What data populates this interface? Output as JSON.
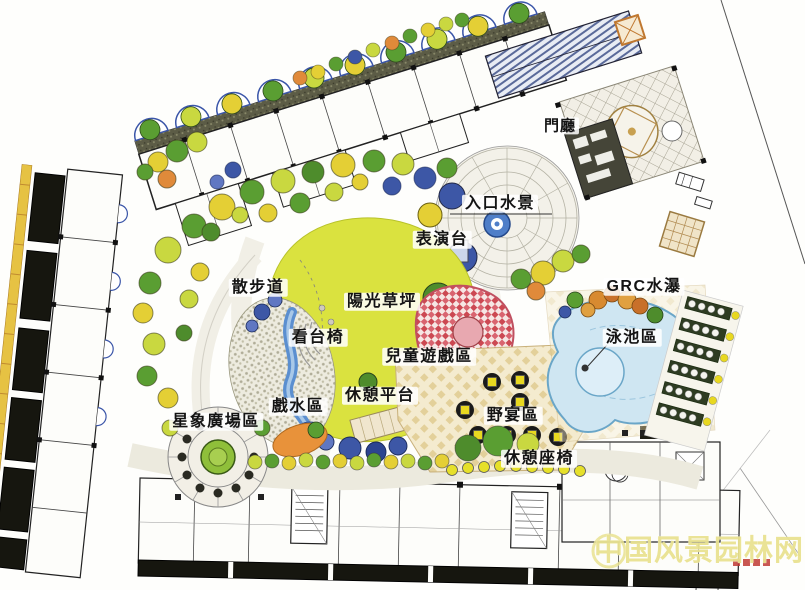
{
  "plan": {
    "title": "residential landscape site plan",
    "labels": {
      "lobby": "門廳",
      "entrance_water": "入口水景",
      "stage": "表演台",
      "walkway": "散步道",
      "sun_lawn": "陽光草坪",
      "grc_waterfall": "GRC水瀑",
      "grandstand_chairs": "看台椅",
      "children_play": "兒童遊戲區",
      "pool_area": "泳池區",
      "rest_platform": "休憩平台",
      "water_play": "戲水區",
      "star_plaza": "星象廣場區",
      "picnic_area": "野宴區",
      "rest_seats": "休憩座椅"
    },
    "watermark": "中国风景园林网",
    "colors": {
      "lawn": "#dae23f",
      "pool": "#cfe6f2",
      "stream": "#5b8fd0",
      "mosaic_red": "#cc4852",
      "picnic_tan": "#f2e7c8",
      "tree_green": "#5a9e32",
      "tree_yellow": "#e4cf35",
      "tree_blue": "#3d57a6",
      "umbrella_yellow": "#e8d820",
      "watermark_yellow": "#e9e291"
    }
  }
}
